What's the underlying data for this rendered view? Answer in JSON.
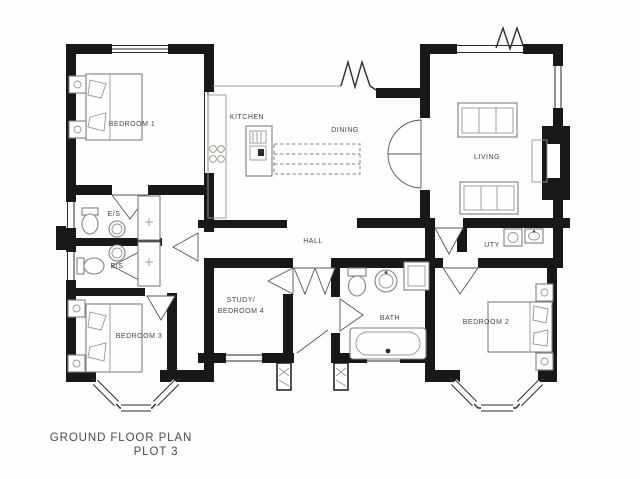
{
  "title": {
    "line1": "GROUND FLOOR PLAN",
    "line2": "PLOT 3"
  },
  "rooms": [
    {
      "id": "bedroom-1",
      "label": "BEDROOM 1",
      "x": 132,
      "y": 126
    },
    {
      "id": "kitchen",
      "label": "KITCHEN",
      "x": 247,
      "y": 119
    },
    {
      "id": "dining",
      "label": "DINING",
      "x": 345,
      "y": 132
    },
    {
      "id": "living",
      "label": "LIVING",
      "x": 487,
      "y": 159
    },
    {
      "id": "es-upper",
      "label": "E/S",
      "x": 114,
      "y": 216
    },
    {
      "id": "es-lower",
      "label": "E/S",
      "x": 117,
      "y": 268
    },
    {
      "id": "hall",
      "label": "HALL",
      "x": 313,
      "y": 243
    },
    {
      "id": "uty",
      "label": "UTY",
      "x": 492,
      "y": 247
    },
    {
      "id": "study",
      "label": "STUDY/",
      "x": 241,
      "y": 302
    },
    {
      "id": "bedroom-4",
      "label": "BEDROOM 4",
      "x": 241,
      "y": 313
    },
    {
      "id": "bath",
      "label": "BATH",
      "x": 390,
      "y": 320
    },
    {
      "id": "bedroom-3",
      "label": "BEDROOM 3",
      "x": 139,
      "y": 338
    },
    {
      "id": "bedroom-2",
      "label": "BEDROOM 2",
      "x": 486,
      "y": 324
    }
  ],
  "colors": {
    "wall": "#181818",
    "furniture": "#80807c",
    "paper": "#fdfdfc",
    "label": "#45453f"
  }
}
